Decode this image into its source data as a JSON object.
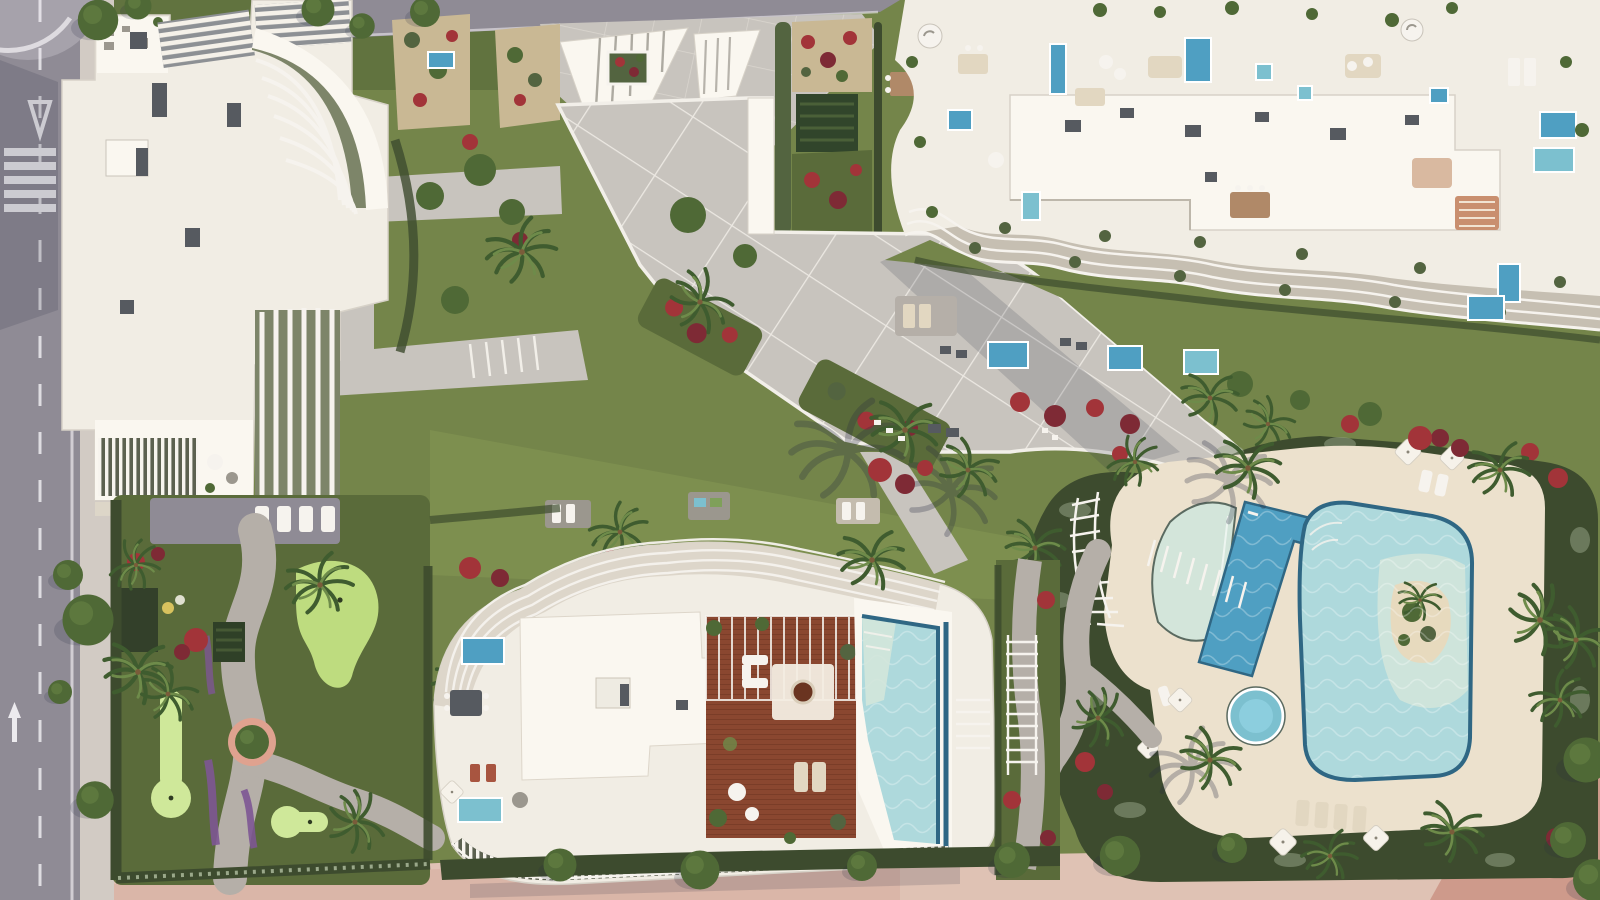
{
  "scene": {
    "kind": "aerial-architectural-render",
    "elements": [
      "access-road",
      "pedestrian-crosswalk",
      "yield-marking",
      "lane-arrow",
      "building-northwest",
      "building-northeast",
      "building-south",
      "rooftop-terraces",
      "rooftop-plunge-pools",
      "rooftop-infinity-pool",
      "rooftop-wood-deck",
      "central-promenade",
      "entrance-plaza",
      "garden-paths",
      "communal-leisure-pool",
      "lap-pool",
      "kids-pool",
      "pool-island",
      "pool-sun-deck",
      "putting-green-garden",
      "lawns",
      "hedges",
      "red-flower-beds",
      "purple-flower-beds",
      "palm-trees",
      "trees",
      "pergolas",
      "sun-loungers",
      "parasols",
      "outdoor-furniture",
      "pink-perimeter-sidewalk"
    ]
  },
  "colors": {
    "asphalt": "#8f8b95",
    "asphalt_light": "#a6a2ab",
    "road_marking": "#eceaee",
    "sidewalk": "#d2cbc4",
    "sidewalk_pink": "#dfc2b4",
    "sidewalk_pink_dark": "#cb9384",
    "plaza_paver": "#c8c4be",
    "path_gravel": "#b5afa8",
    "stripe_white": "#f2efe9",
    "building_white": "#f1ede4",
    "building_bright": "#faf7f0",
    "building_shadow": "#d7d2c8",
    "ac_unit": "#565a60",
    "lawn": "#74854a",
    "lawn_dark": "#5a6b3a",
    "lawn_bright": "#859853",
    "putting_green": "#bedc7f",
    "putting_green_light": "#cfe89a",
    "hedge_dark": "#3d4b2e",
    "hedge_mid": "#536440",
    "hedge_speckled": "#9aa88a",
    "tree_green": "#4f6936",
    "palm_green": "#3f5c2f",
    "palm_light": "#6e8b4a",
    "trunk_brown": "#7a5c3a",
    "flower_red": "#a23439",
    "flower_crimson": "#7e2a35",
    "flower_purple": "#7d5693",
    "soil": "#c9b894",
    "pool_pale": "#d3e5da",
    "pool_light": "#aed9dc",
    "pool_mid": "#7cc0cf",
    "pool_deep": "#4f9fc2",
    "pool_rim": "#2f6784",
    "pool_sand_deck": "#ece1cd",
    "pool_island": "#e7dabe",
    "wood_deck": "#8a4730",
    "wood_deck_dark": "#6a3420",
    "furniture_white": "#f6f3ee",
    "furniture_beige": "#e2d7c1",
    "furniture_gray": "#9b978e",
    "shadow_soft": "rgba(40,42,64,0.16)",
    "shadow": "rgba(40,42,64,0.28)"
  }
}
